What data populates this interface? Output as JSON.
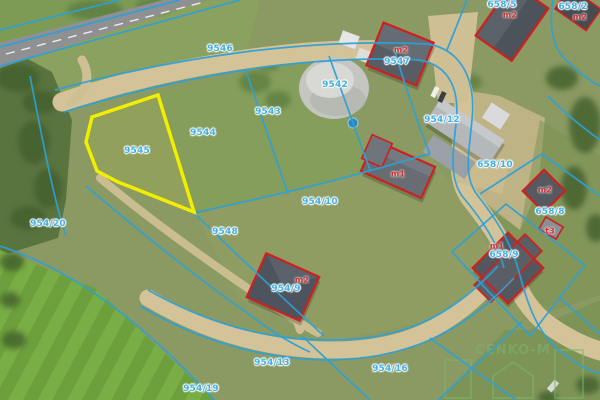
{
  "map": {
    "kind": "aerial-orthophoto-with-cadastral-overlay",
    "highlighted_parcel": "9545",
    "colors": {
      "parcel_line": "#2da0d6",
      "parcel_label": "#41afe2",
      "building_label": "#d92b2b",
      "building_outline": "#cf1f1f",
      "highlight_outline": "#f2ee00"
    },
    "watermark_text": "CENKO-M",
    "parcel_labels": [
      {
        "text": "9546",
        "x": 220,
        "y": 49
      },
      {
        "text": "9542",
        "x": 335,
        "y": 85
      },
      {
        "text": "9547",
        "x": 397,
        "y": 62
      },
      {
        "text": "658/5",
        "x": 502,
        "y": 5
      },
      {
        "text": "658/2",
        "x": 573,
        "y": 7
      },
      {
        "text": "9543",
        "x": 268,
        "y": 112
      },
      {
        "text": "9544",
        "x": 203,
        "y": 133
      },
      {
        "text": "9545",
        "x": 137,
        "y": 151
      },
      {
        "text": "954/12",
        "x": 442,
        "y": 120
      },
      {
        "text": "658/10",
        "x": 495,
        "y": 165
      },
      {
        "text": "658/8",
        "x": 550,
        "y": 212
      },
      {
        "text": "658/9",
        "x": 504,
        "y": 255
      },
      {
        "text": "954/10",
        "x": 320,
        "y": 202
      },
      {
        "text": "9548",
        "x": 225,
        "y": 232
      },
      {
        "text": "954/20",
        "x": 48,
        "y": 224
      },
      {
        "text": "954/9",
        "x": 286,
        "y": 289
      },
      {
        "text": "954/13",
        "x": 272,
        "y": 363
      },
      {
        "text": "954/19",
        "x": 201,
        "y": 389
      },
      {
        "text": "954/16",
        "x": 390,
        "y": 369
      }
    ],
    "building_labels": [
      {
        "text": "m2",
        "x": 401,
        "y": 50
      },
      {
        "text": "m2",
        "x": 510,
        "y": 15
      },
      {
        "text": "m2",
        "x": 580,
        "y": 17
      },
      {
        "text": "m1",
        "x": 398,
        "y": 174
      },
      {
        "text": "m2",
        "x": 302,
        "y": 280
      },
      {
        "text": "m2",
        "x": 545,
        "y": 190
      },
      {
        "text": "t3",
        "x": 550,
        "y": 231
      },
      {
        "text": "m1",
        "x": 497,
        "y": 246
      }
    ]
  }
}
